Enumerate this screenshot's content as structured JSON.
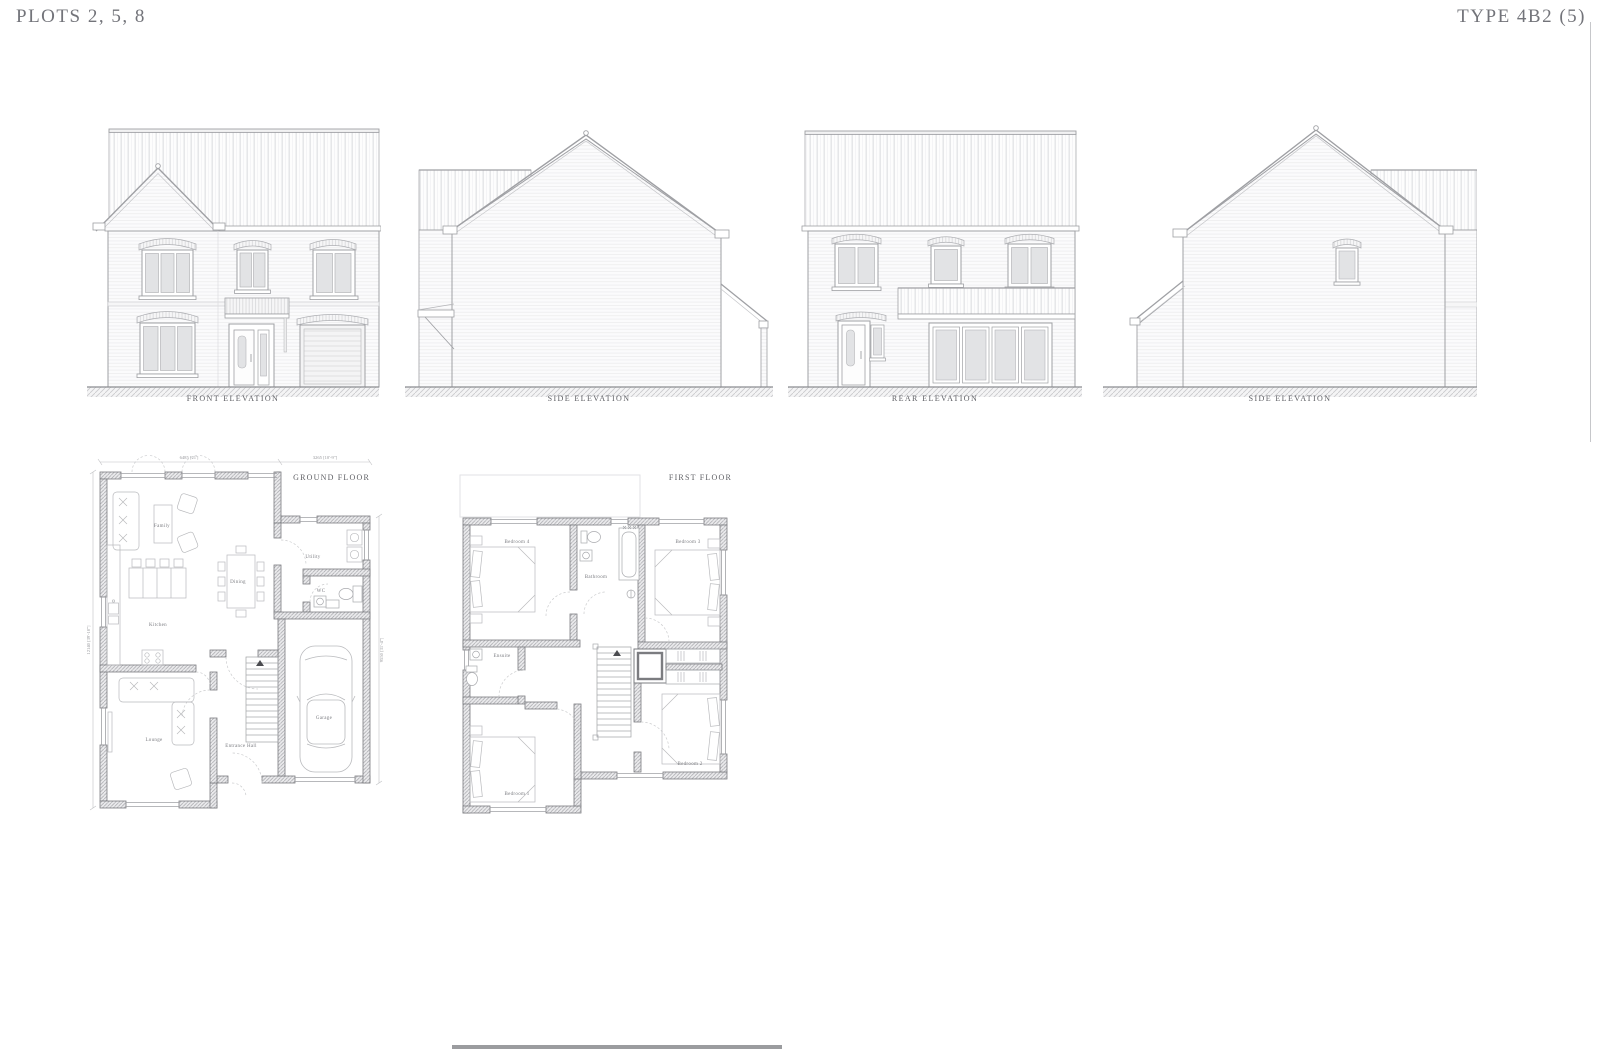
{
  "header": {
    "left_title": "PLOTS 2, 5, 8",
    "right_title": "TYPE 4B2 (5)"
  },
  "elevations": {
    "front": {
      "label": "FRONT ELEVATION"
    },
    "side_left": {
      "label": "SIDE ELEVATION"
    },
    "rear": {
      "label": "REAR ELEVATION"
    },
    "side_right": {
      "label": "SIDE ELEVATION"
    }
  },
  "plans": {
    "ground": {
      "label": "GROUND FLOOR",
      "rooms": {
        "family": "Family",
        "dining": "Dining",
        "utility": "Utility",
        "wc": "WC",
        "kitchen": "Kitchen",
        "lounge": "Lounge",
        "entrance_hall": "Entrance Hall",
        "garage": "Garage"
      },
      "dimensions": {
        "top_main": "6485 [21']",
        "top_garage": "3265 [10'-9\"]",
        "left": "12140 [39'-10\"]",
        "right": "9550 [31'-4\"]"
      }
    },
    "first": {
      "label": "FIRST FLOOR",
      "rooms": {
        "bedroom4": "Bedroom 4",
        "bathroom": "Bathroom",
        "bedroom3": "Bedroom 3",
        "ensuite": "Ensuite",
        "bedroom1": "Bedroom 1",
        "bedroom2": "Bedroom 2"
      }
    }
  },
  "colors": {
    "line": "#9fa0a4",
    "wall_line": "#7b7c80",
    "glass": "#e2e3e5",
    "text": "#5e5f64"
  }
}
